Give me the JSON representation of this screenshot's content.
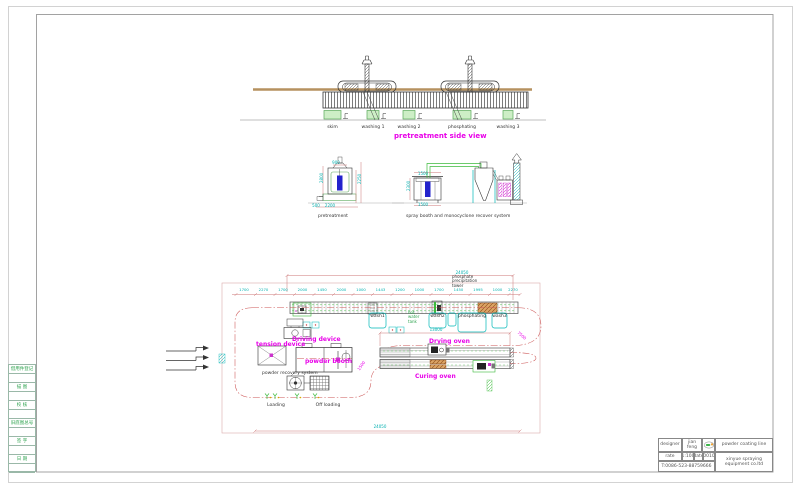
{
  "side_view": {
    "title": "pretreatment side view",
    "tanks": [
      {
        "label": "skim",
        "x": 332.5
      },
      {
        "label": "washing 1",
        "x": 373
      },
      {
        "label": "washing 2",
        "x": 409
      },
      {
        "label": "phosphating",
        "x": 462
      },
      {
        "label": "washing 3",
        "x": 508
      }
    ]
  },
  "elevations": {
    "left_label": "pretreatment",
    "right_label": "spray booth and monocyclone recover system"
  },
  "plan": {
    "labels": {
      "driving_device": "Driving device",
      "tension_device": "tension device",
      "powder_booth": "powder booth",
      "drying_oven": "Drying oven",
      "curing_oven": "Curing oven",
      "loading": "Loading",
      "off_loading": "Off loading",
      "powder_recovery": "powder recovery system"
    },
    "notes": {
      "tower": [
        "phosphate",
        "precipitation",
        "tower"
      ],
      "hot_water": [
        "hot",
        "water",
        "tank"
      ]
    },
    "tank_labels": [
      {
        "label": "wash1",
        "x": 377.5
      },
      {
        "label": "wash2",
        "x": 437.5
      },
      {
        "label": "phosphating",
        "x": 472
      },
      {
        "label": "wash3",
        "x": 499.5
      }
    ],
    "segment_dims": [
      {
        "v": "1700",
        "x": 244
      },
      {
        "v": "2270",
        "x": 263.5
      },
      {
        "v": "1700",
        "x": 283
      },
      {
        "v": "2000",
        "x": 302.5
      },
      {
        "v": "1450",
        "x": 322
      },
      {
        "v": "2000",
        "x": 341.5
      },
      {
        "v": "1000",
        "x": 361
      },
      {
        "v": "1443",
        "x": 380.5
      },
      {
        "v": "1200",
        "x": 400
      },
      {
        "v": "1000",
        "x": 419.5
      },
      {
        "v": "1700",
        "x": 439
      },
      {
        "v": "1450",
        "x": 458.5
      },
      {
        "v": "1995",
        "x": 478
      },
      {
        "v": "1000",
        "x": 497.5
      },
      {
        "v": "2270",
        "x": 513
      }
    ],
    "dims": [
      {
        "v": "24050",
        "x": 462,
        "y": 270.5
      },
      {
        "v": "13000",
        "x": 436,
        "y": 328
      },
      {
        "v": "24050",
        "x": 380,
        "y": 424.5
      },
      {
        "v": "2800",
        "x": 319.5,
        "y": 183,
        "r": -90
      },
      {
        "v": "2250",
        "x": 357.5,
        "y": 184,
        "r": -90
      },
      {
        "v": "900",
        "x": 336,
        "y": 160.5
      },
      {
        "v": "2200",
        "x": 330,
        "y": 204
      },
      {
        "v": "500",
        "x": 316,
        "y": 204
      },
      {
        "v": "2300",
        "x": 407,
        "y": 191,
        "r": -90
      },
      {
        "v": "1500",
        "x": 423,
        "y": 171.5
      },
      {
        "v": "1500",
        "x": 423,
        "y": 202.5
      },
      {
        "v": "7500",
        "x": 519,
        "y": 331,
        "r": 40,
        "c": "#e800e8"
      },
      {
        "v": "1500",
        "x": 357,
        "y": 369,
        "r": -55,
        "c": "#e800e8"
      }
    ]
  },
  "title_block": {
    "designer_label": "designer",
    "designer_value": "jian feng",
    "rate_label": "rate",
    "rate_value": "1:100",
    "date_label": "date",
    "date_value": "200107",
    "phone": "T:0086-523-88759666",
    "product": "powder coating line",
    "company_line1": "xinyue spraying",
    "company_line2": "equipment co.ltd"
  },
  "left_strip": {
    "cells": [
      "借用件登记",
      "描 图",
      "校 核",
      "旧底图总号",
      "签 字",
      "日 期"
    ]
  }
}
